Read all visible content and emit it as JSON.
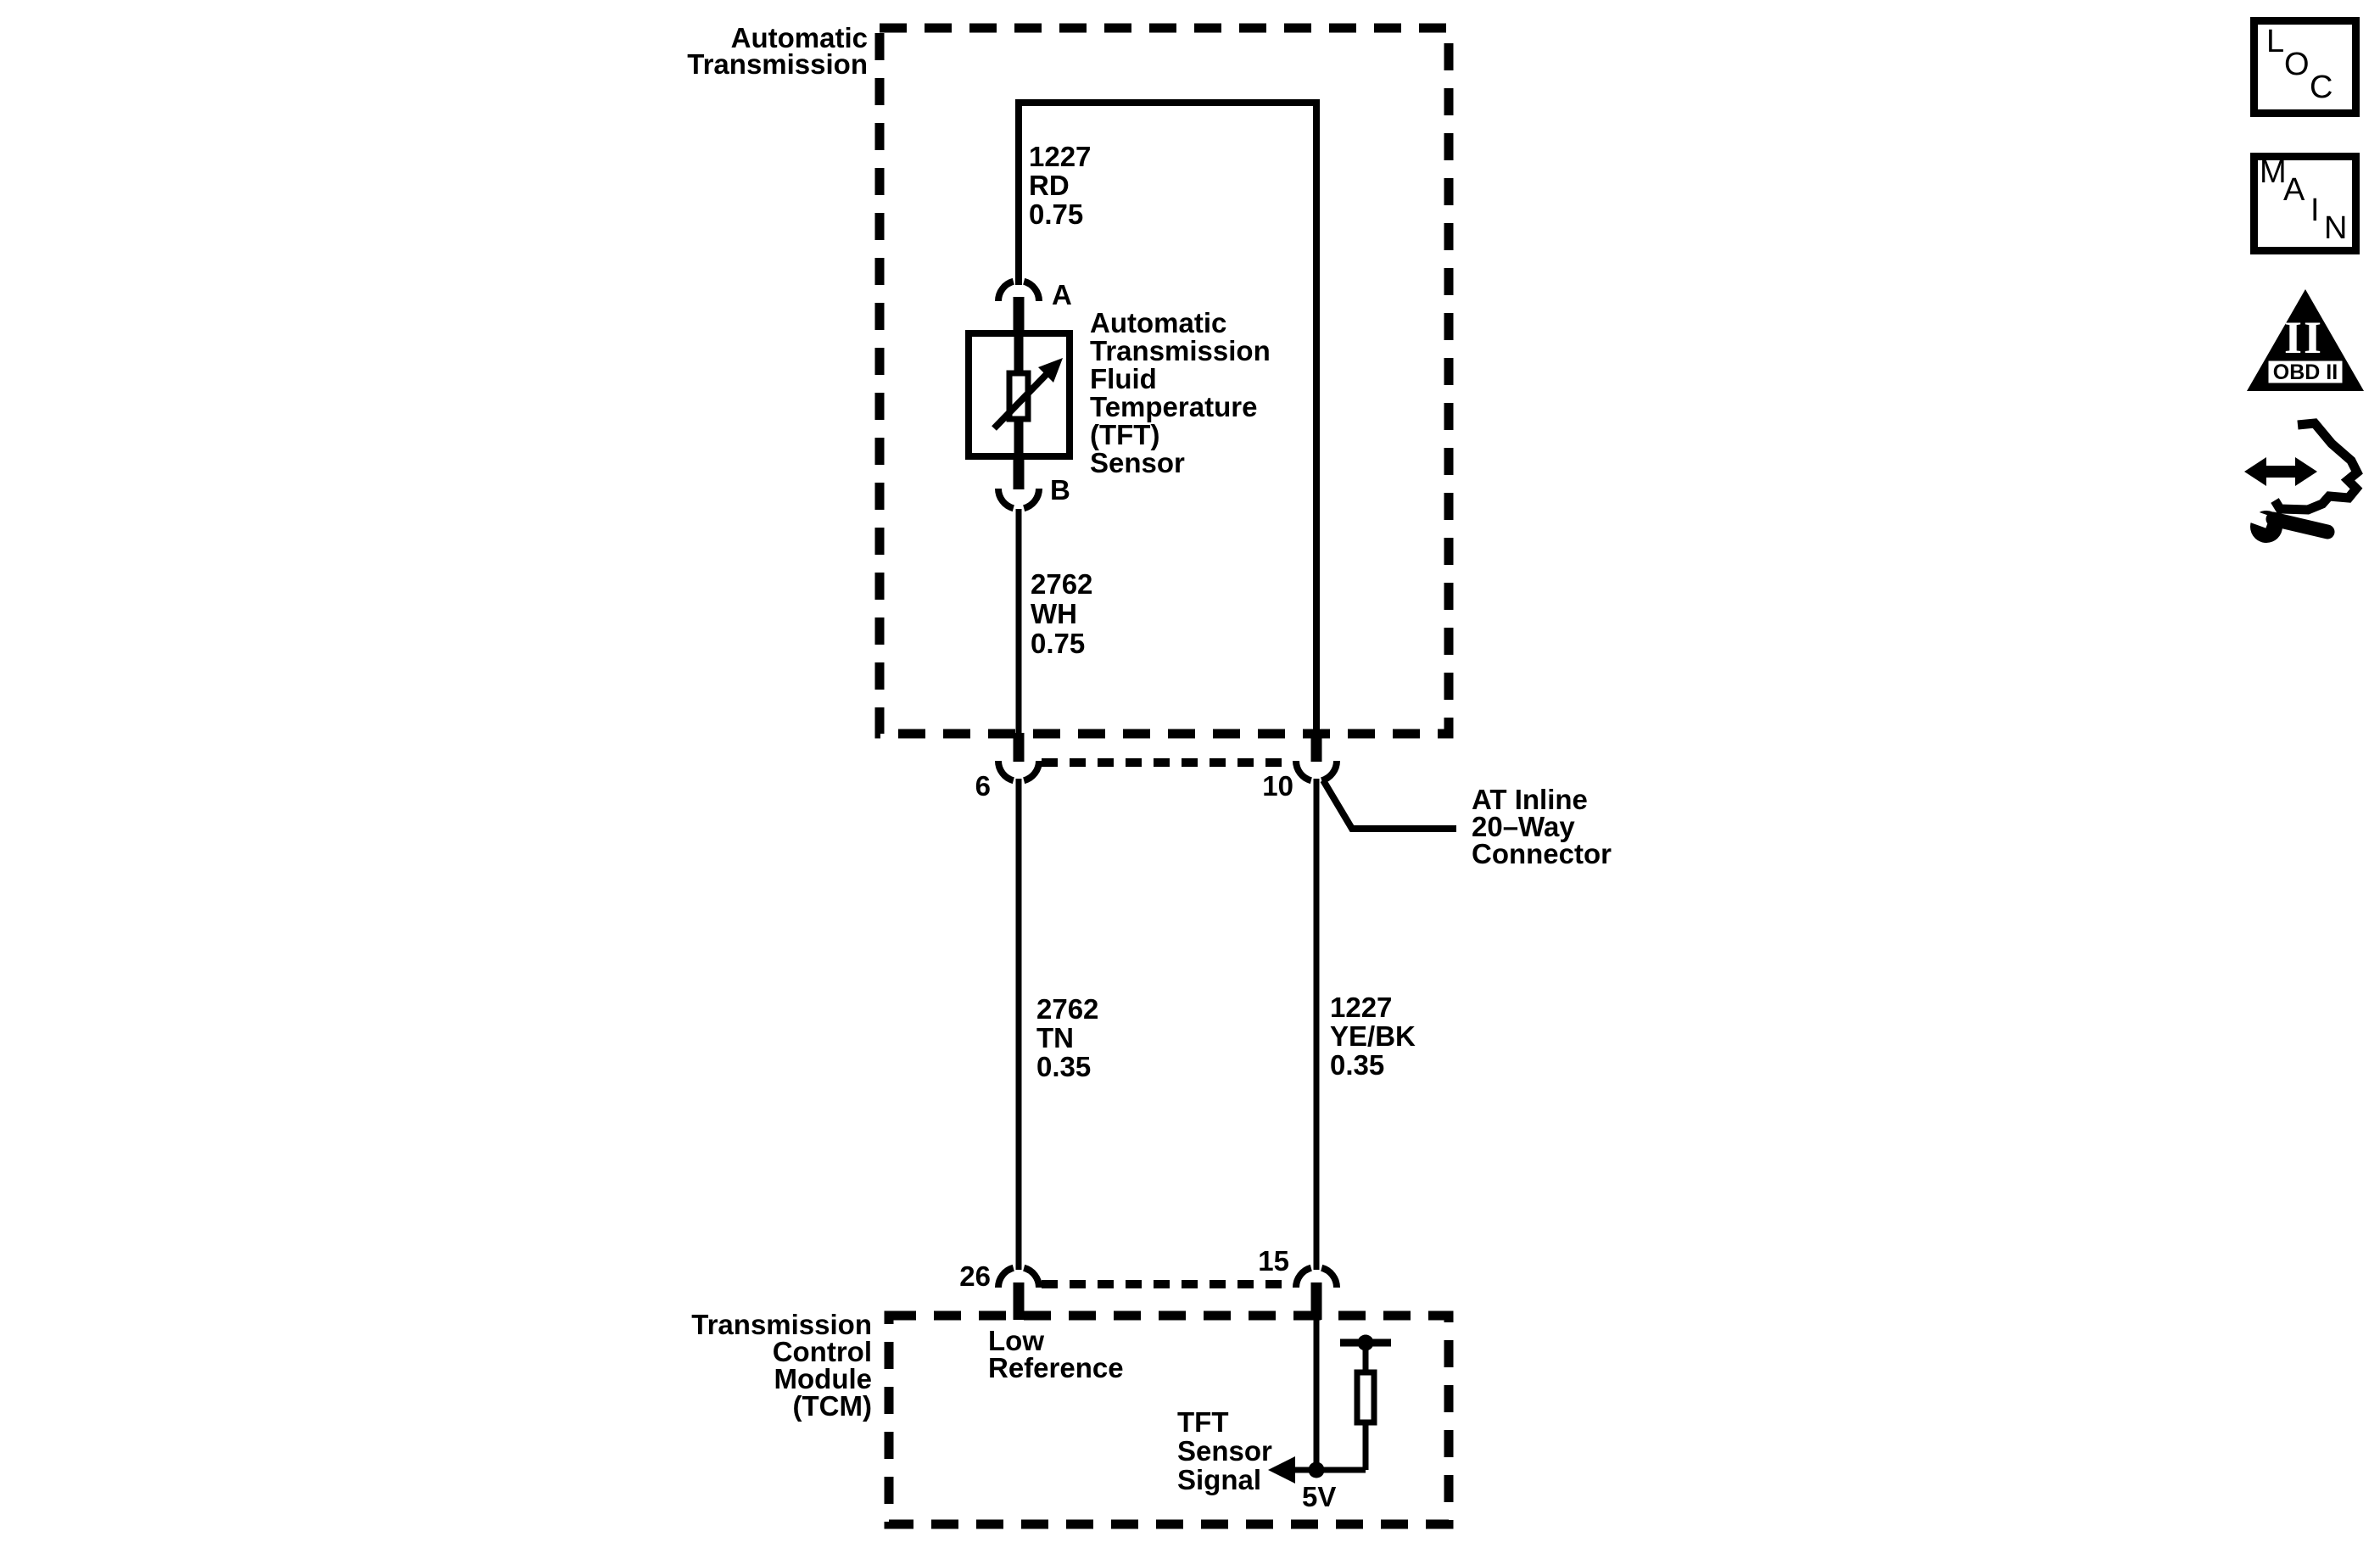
{
  "diagram": {
    "system_label": [
      "Automatic",
      "Transmission"
    ],
    "tcm_label": [
      "Transmission",
      "Control",
      "Module",
      "(TCM)"
    ],
    "sensor_label": [
      "Automatic",
      "Transmission",
      "Fluid",
      "Temperature",
      "(TFT)",
      "Sensor"
    ],
    "inline_connector_label": [
      "AT Inline",
      "20–Way",
      "Connector"
    ],
    "low_reference_label": [
      "Low",
      "Reference"
    ],
    "tft_signal_label": [
      "TFT",
      "Sensor",
      "Signal"
    ],
    "supply_label": "5V",
    "terminals": {
      "a": "A",
      "b": "B",
      "t6": "6",
      "t10": "10",
      "t26": "26",
      "t15": "15"
    },
    "wires": {
      "sensor_supply": [
        "1227",
        "RD",
        "0.75"
      ],
      "sensor_return": [
        "2762",
        "WH",
        "0.75"
      ],
      "low_reference": [
        "2762",
        "TN",
        "0.35"
      ],
      "signal": [
        "1227",
        "YE/BK",
        "0.35"
      ]
    }
  },
  "sidebar_icons": {
    "loc_letters": [
      "L",
      "O",
      "C"
    ],
    "main_letters": [
      "M",
      "A",
      "I",
      "N"
    ],
    "obd_label": "OBD II",
    "obd_numeral": "II"
  },
  "colors": {
    "ink": "#000000",
    "paper": "#ffffff"
  }
}
